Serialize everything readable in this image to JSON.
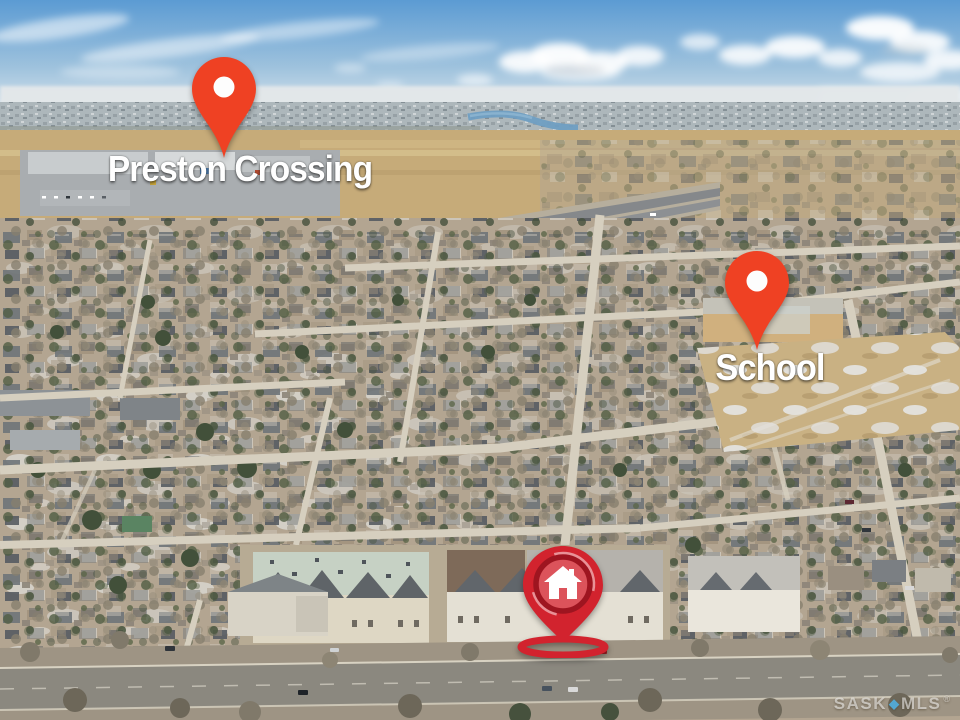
{
  "annotations": {
    "preston_crossing": {
      "label": "Preston Crossing",
      "pin_icon": "map-pin-icon"
    },
    "school": {
      "label": "School",
      "pin_icon": "map-pin-icon"
    },
    "subject_property": {
      "pin_icon": "home-pin-icon"
    }
  },
  "watermark": {
    "left": "SASK",
    "diamond_glyph": "◆",
    "separator_icon": "diamond-icon",
    "right": "MLS",
    "registered_mark": "®"
  },
  "colors": {
    "pin_orange": "#EF4123",
    "pin_red": "#D2232E",
    "pin_ring_dark": "#9E1520",
    "pin_hole_white": "#FDFDFD",
    "house_icon_white": "#FFFFFF",
    "watermark_diamond_blue": "#4FB3E8",
    "sky_blue": "#5D9FD6",
    "field_tan": "#C6AB79",
    "label_text": "#FFFFFF"
  }
}
